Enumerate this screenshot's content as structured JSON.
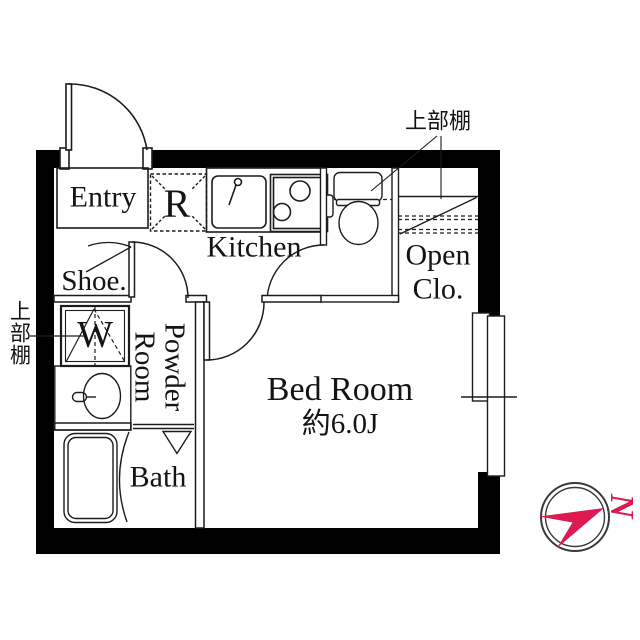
{
  "labels": {
    "entry": "Entry",
    "fridge": "R",
    "kitchen": "Kitchen",
    "shoe": "Shoe.",
    "washer": "W",
    "powder_line1": "Powder",
    "powder_line2": "Room",
    "bath": "Bath",
    "bedroom": "Bed Room",
    "bedroom_size": "約6.0J",
    "open_closet_line1": "Open",
    "open_closet_line2": "Clo.",
    "shelf_top": "上部棚",
    "shelf_left": "上部棚",
    "north": "N"
  },
  "colors": {
    "background": "#ffffff",
    "wall": "#000000",
    "line": "#1c1c1c",
    "accent_red": "#dc1a52"
  }
}
